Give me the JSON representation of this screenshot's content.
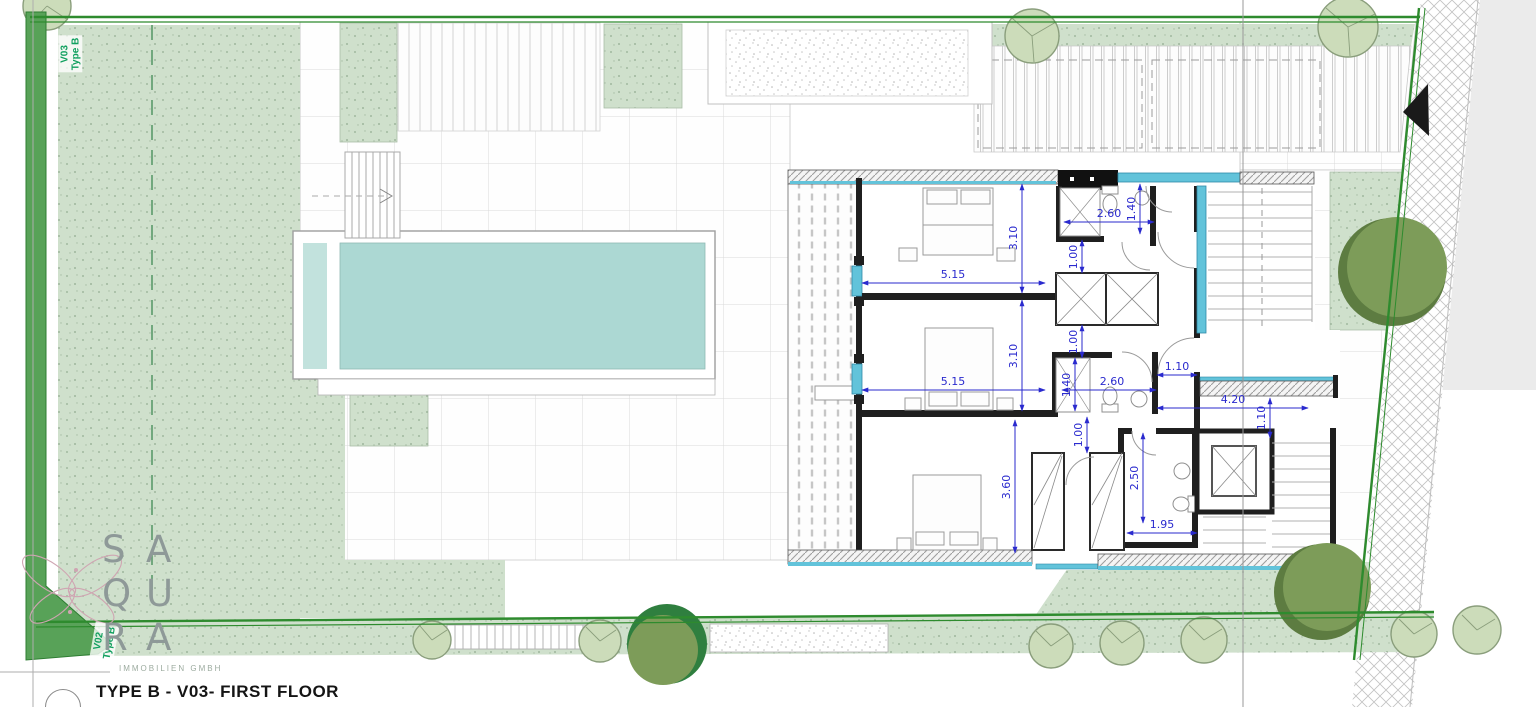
{
  "page": {
    "title": "TYPE B - V03- FIRST FLOOR",
    "company": "IMMOBILIEN GMBH"
  },
  "logo": {
    "letters": [
      "S",
      "A",
      "Q",
      "U",
      "R",
      "A"
    ]
  },
  "plot_labels": {
    "top": {
      "line1": "V03",
      "line2": "Type B"
    },
    "bottom": {
      "line1": "V02",
      "line2": "Type B"
    }
  },
  "dimensions": [
    {
      "value": "5.15",
      "x1": 862,
      "y1": 283,
      "x2": 1045,
      "y2": 283,
      "lx": 953,
      "ly": 278,
      "rot": 0
    },
    {
      "value": "3.10",
      "x1": 1022,
      "y1": 184,
      "x2": 1022,
      "y2": 293,
      "lx": 1017,
      "ly": 238,
      "rot": -90
    },
    {
      "value": "2.60",
      "x1": 1064,
      "y1": 222,
      "x2": 1154,
      "y2": 222,
      "lx": 1109,
      "ly": 217,
      "rot": 0
    },
    {
      "value": "1.40",
      "x1": 1140,
      "y1": 184,
      "x2": 1140,
      "y2": 234,
      "lx": 1135,
      "ly": 209,
      "rot": -90
    },
    {
      "value": "1.00",
      "x1": 1082,
      "y1": 240,
      "x2": 1082,
      "y2": 273,
      "lx": 1077,
      "ly": 257,
      "rot": -90
    },
    {
      "value": "1.00",
      "x1": 1082,
      "y1": 325,
      "x2": 1082,
      "y2": 358,
      "lx": 1077,
      "ly": 342,
      "rot": -90
    },
    {
      "value": "5.15",
      "x1": 862,
      "y1": 390,
      "x2": 1045,
      "y2": 390,
      "lx": 953,
      "ly": 385,
      "rot": 0
    },
    {
      "value": "3.10",
      "x1": 1022,
      "y1": 300,
      "x2": 1022,
      "y2": 411,
      "lx": 1017,
      "ly": 356,
      "rot": -90
    },
    {
      "value": "1.40",
      "x1": 1075,
      "y1": 358,
      "x2": 1075,
      "y2": 411,
      "lx": 1070,
      "ly": 385,
      "rot": -90
    },
    {
      "value": "2.60",
      "x1": 1062,
      "y1": 390,
      "x2": 1156,
      "y2": 390,
      "lx": 1112,
      "ly": 385,
      "rot": 0
    },
    {
      "value": "1.10",
      "x1": 1157,
      "y1": 375,
      "x2": 1197,
      "y2": 375,
      "lx": 1177,
      "ly": 370,
      "rot": 0
    },
    {
      "value": "4.20",
      "x1": 1157,
      "y1": 408,
      "x2": 1308,
      "y2": 408,
      "lx": 1233,
      "ly": 403,
      "rot": 0
    },
    {
      "value": "1.10",
      "x1": 1270,
      "y1": 398,
      "x2": 1270,
      "y2": 438,
      "lx": 1265,
      "ly": 418,
      "rot": -90
    },
    {
      "value": "1.00",
      "x1": 1087,
      "y1": 417,
      "x2": 1087,
      "y2": 453,
      "lx": 1082,
      "ly": 435,
      "rot": -90
    },
    {
      "value": "3.60",
      "x1": 1015,
      "y1": 420,
      "x2": 1015,
      "y2": 553,
      "lx": 1010,
      "ly": 487,
      "rot": -90
    },
    {
      "value": "2.50",
      "x1": 1143,
      "y1": 433,
      "x2": 1143,
      "y2": 523,
      "lx": 1138,
      "ly": 478,
      "rot": -90
    },
    {
      "value": "1.95",
      "x1": 1127,
      "y1": 533,
      "x2": 1197,
      "y2": 533,
      "lx": 1162,
      "ly": 528,
      "rot": 0
    }
  ],
  "colors": {
    "grass": "#cfe0cc",
    "boundary_green": "#2e8b2e",
    "pool_water": "#acd8d3",
    "glass_cyan": "#62c3da",
    "dimension_blue": "#2a2ace",
    "tree_dark": "#7d9c59",
    "tree_light": "#ccdcba",
    "plot_label_green": "#11a05f",
    "wall_black": "#1f1f1f"
  }
}
